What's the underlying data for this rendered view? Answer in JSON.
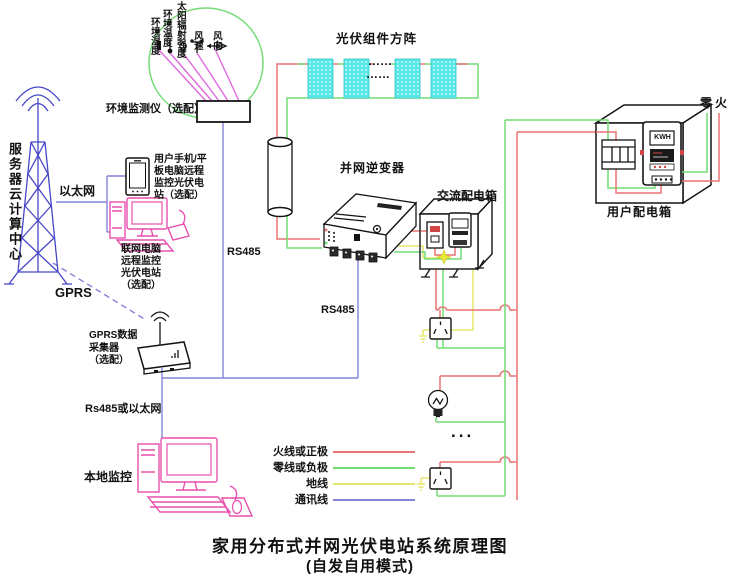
{
  "title": {
    "line1": "家用分布式并网光伏电站系统原理图",
    "line2": "(自发自用模式)"
  },
  "env_station": {
    "sensor_labels": [
      "环境湿度",
      "环境温度",
      "太阳辐射强度",
      "风速",
      "风向"
    ],
    "device_label": "环境监测仪（选配）"
  },
  "cloud": {
    "server_label": "服务器云计算中心",
    "ethernet_label": "以太网",
    "gprs_label": "GPRS"
  },
  "monitoring": {
    "phone_label": "用户手机/平\n板电脑远程\n监控光伏电\n站（选配）",
    "pc_label": "联网电脑\n远程监控\n光伏电站\n（选配）",
    "collector_label": "GPRS数据\n采集器\n（选配）",
    "local_link_label": "Rs485或以太网",
    "local_pc_label": "本地监控"
  },
  "pv": {
    "array_label": "光伏组件方阵",
    "ellipsis": "……"
  },
  "buses": {
    "rs485_left": "RS485",
    "rs485_right": "RS485"
  },
  "equipment": {
    "inverter_label": "并网逆变器",
    "ac_box_label": "交流配电箱",
    "user_box_label": "用户配电箱",
    "meter_display": "KWH",
    "neutral_live_label": "零火"
  },
  "loads": {
    "ellipsis": "..."
  },
  "legend": {
    "items": [
      {
        "label": "火线或正极",
        "color": "#e87474"
      },
      {
        "label": "零线或负极",
        "color": "#74dc74"
      },
      {
        "label": "地线",
        "color": "#e6e66e"
      },
      {
        "label": "通讯线",
        "color": "#8484d8"
      }
    ]
  },
  "palette": {
    "pv_panel_cyan": "#57e8e8",
    "sensor_line_magenta": "#de6ade",
    "device_pink": "#e84fae",
    "tower_blue": "#4646c8",
    "monitor_circle_green": "#74dc74"
  }
}
